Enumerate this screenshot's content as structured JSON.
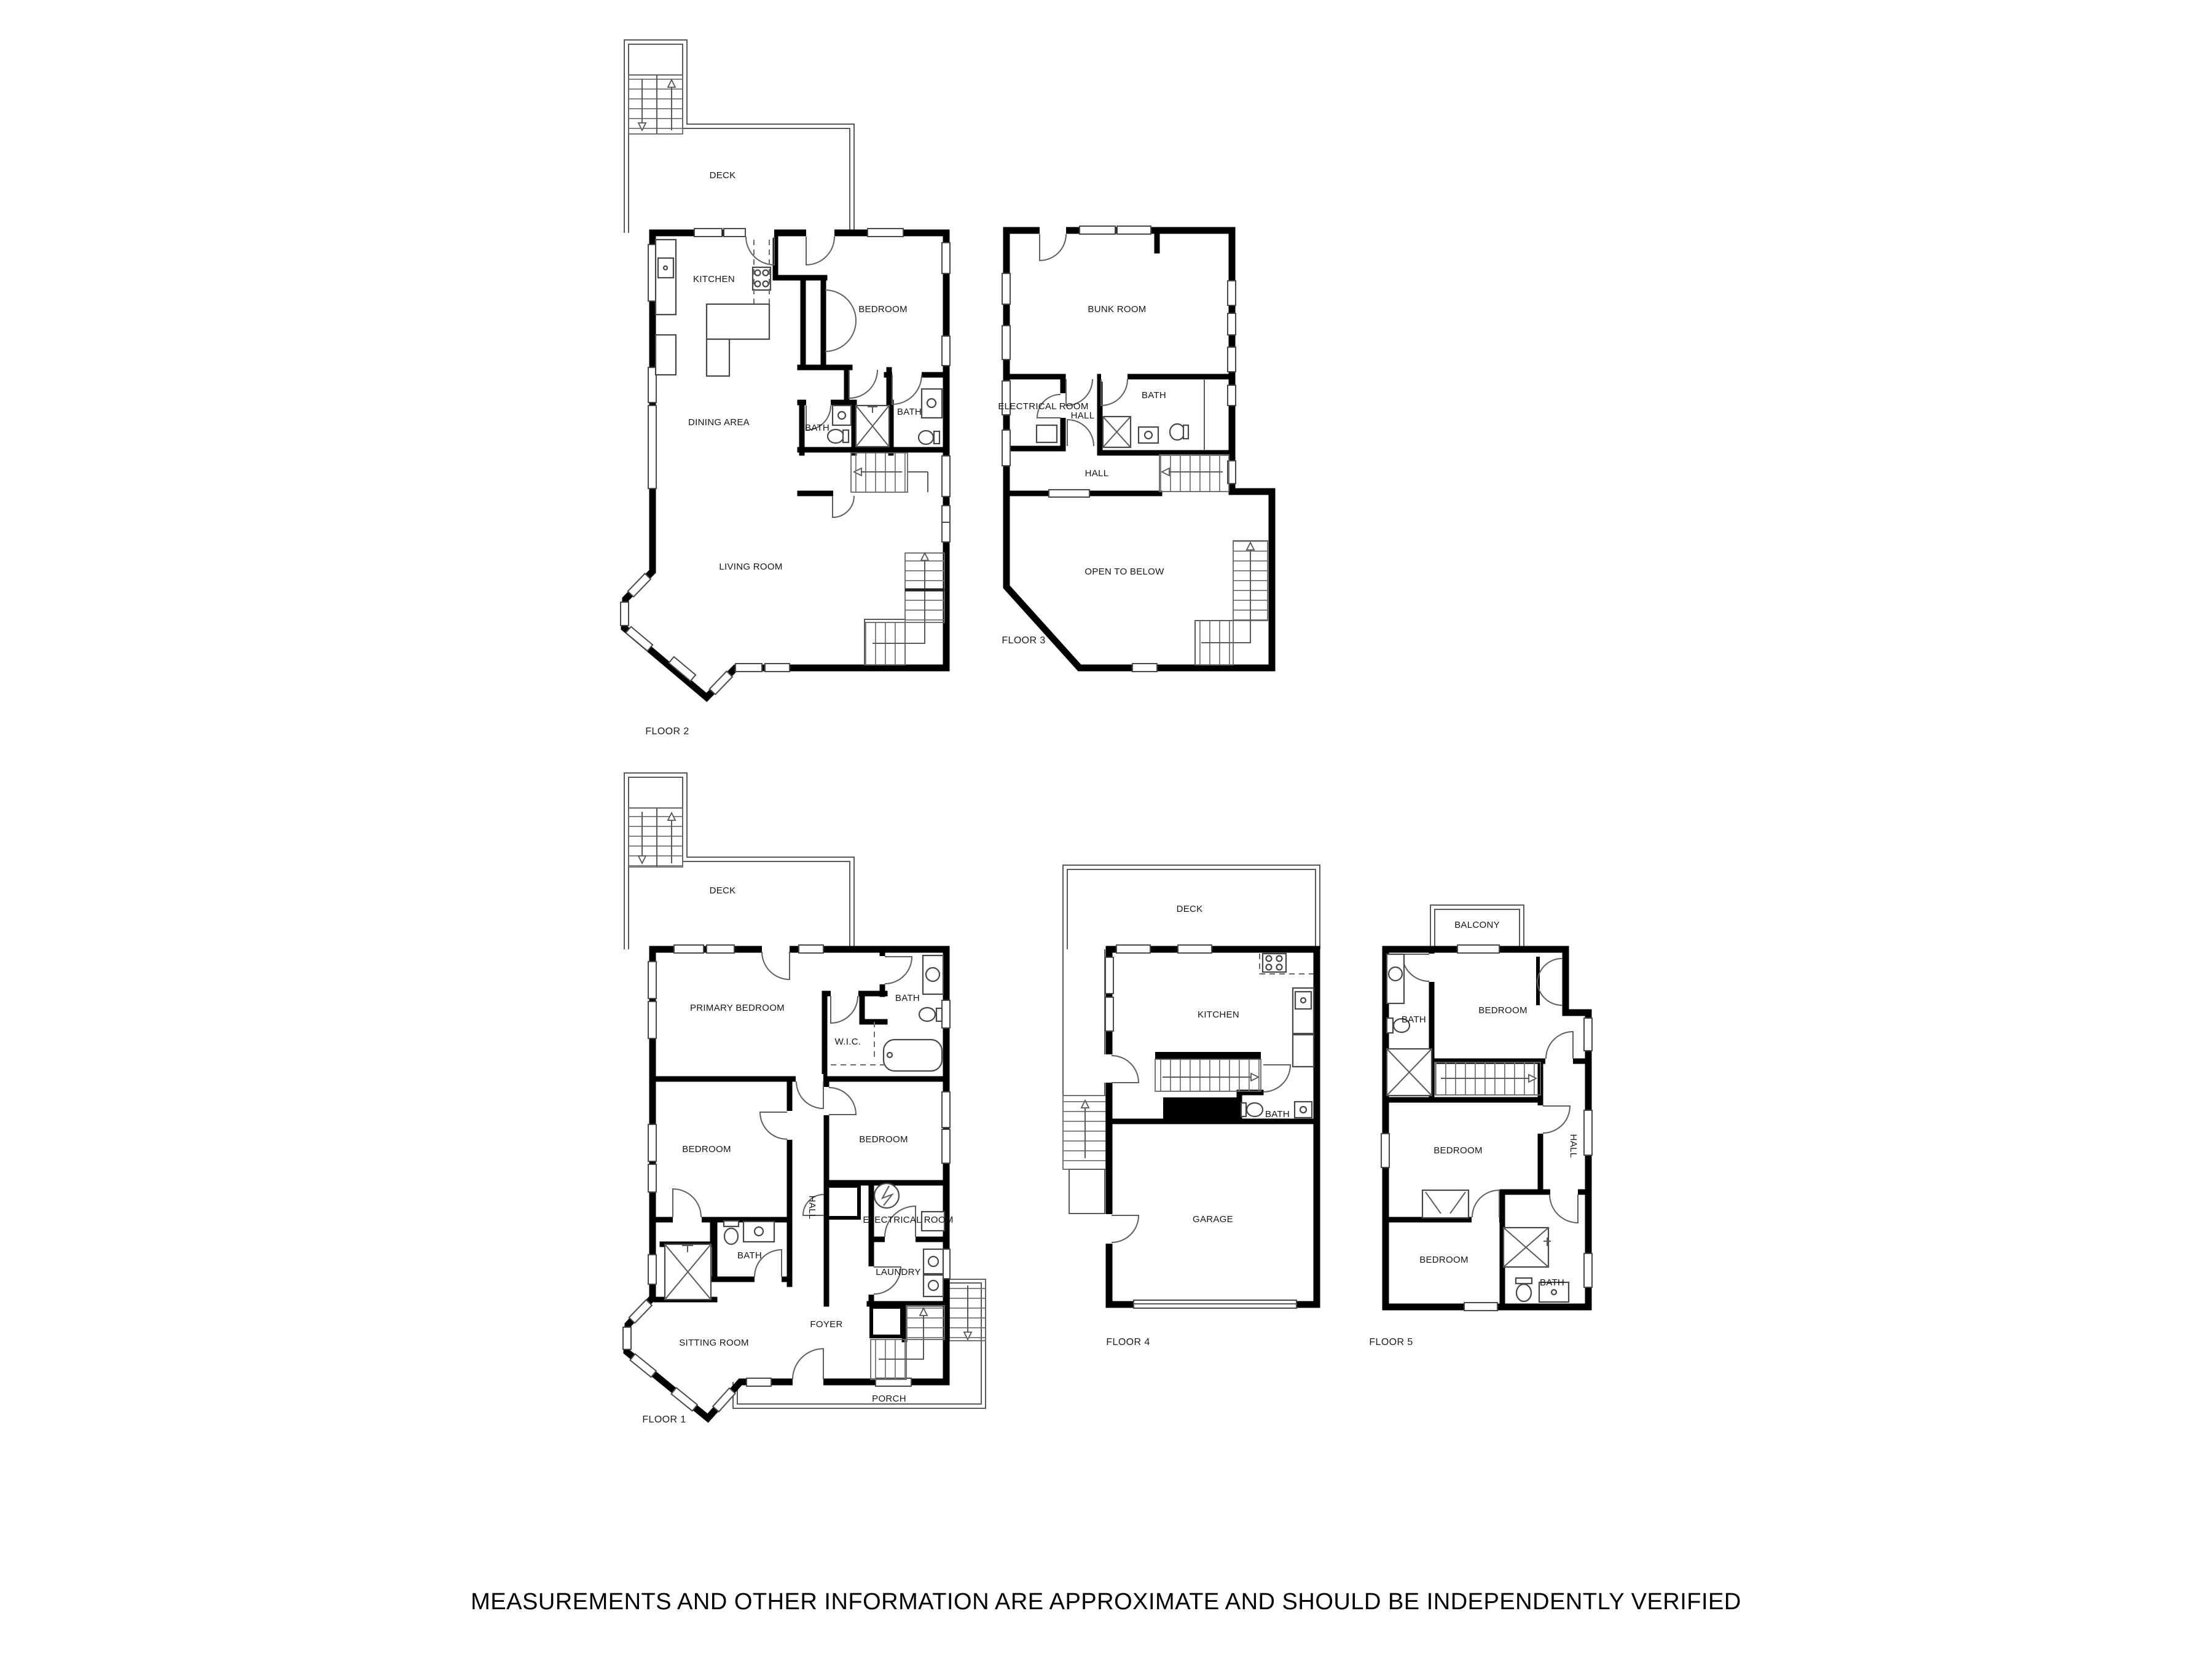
{
  "disclaimer": "MEASUREMENTS AND OTHER INFORMATION ARE APPROXIMATE AND SHOULD BE INDEPENDENTLY VERIFIED",
  "floors": {
    "floor1": {
      "label": "FLOOR 1",
      "rooms": {
        "deck": "DECK",
        "primary": "PRIMARY BEDROOM",
        "wic": "W.I.C.",
        "bath1": "BATH",
        "bedroom1": "BEDROOM",
        "bedroom2": "BEDROOM",
        "hall": "HALL",
        "electrical": "ELECTRICAL ROOM",
        "bath2": "BATH",
        "laundry": "LAUNDRY",
        "foyer": "FOYER",
        "sitting": "SITTING ROOM",
        "porch": "PORCH"
      }
    },
    "floor2": {
      "label": "FLOOR 2",
      "rooms": {
        "deck": "DECK",
        "kitchen": "KITCHEN",
        "bedroom": "BEDROOM",
        "dining": "DINING AREA",
        "bath1": "BATH",
        "bath2": "BATH",
        "living": "LIVING ROOM"
      }
    },
    "floor3": {
      "label": "FLOOR 3",
      "rooms": {
        "bunk": "BUNK ROOM",
        "electrical": "ELECTRICAL ROOM",
        "hall1": "HALL",
        "bath": "BATH",
        "hall2": "HALL",
        "open": "OPEN TO BELOW"
      }
    },
    "floor4": {
      "label": "FLOOR 4",
      "rooms": {
        "deck": "DECK",
        "kitchen": "KITCHEN",
        "bath": "BATH",
        "garage": "GARAGE"
      }
    },
    "floor5": {
      "label": "FLOOR 5",
      "rooms": {
        "balcony": "BALCONY",
        "bath1": "BATH",
        "bedroom1": "BEDROOM",
        "bedroom2": "BEDROOM",
        "hall": "HALL",
        "bedroom3": "BEDROOM",
        "bath2": "BATH"
      }
    }
  }
}
